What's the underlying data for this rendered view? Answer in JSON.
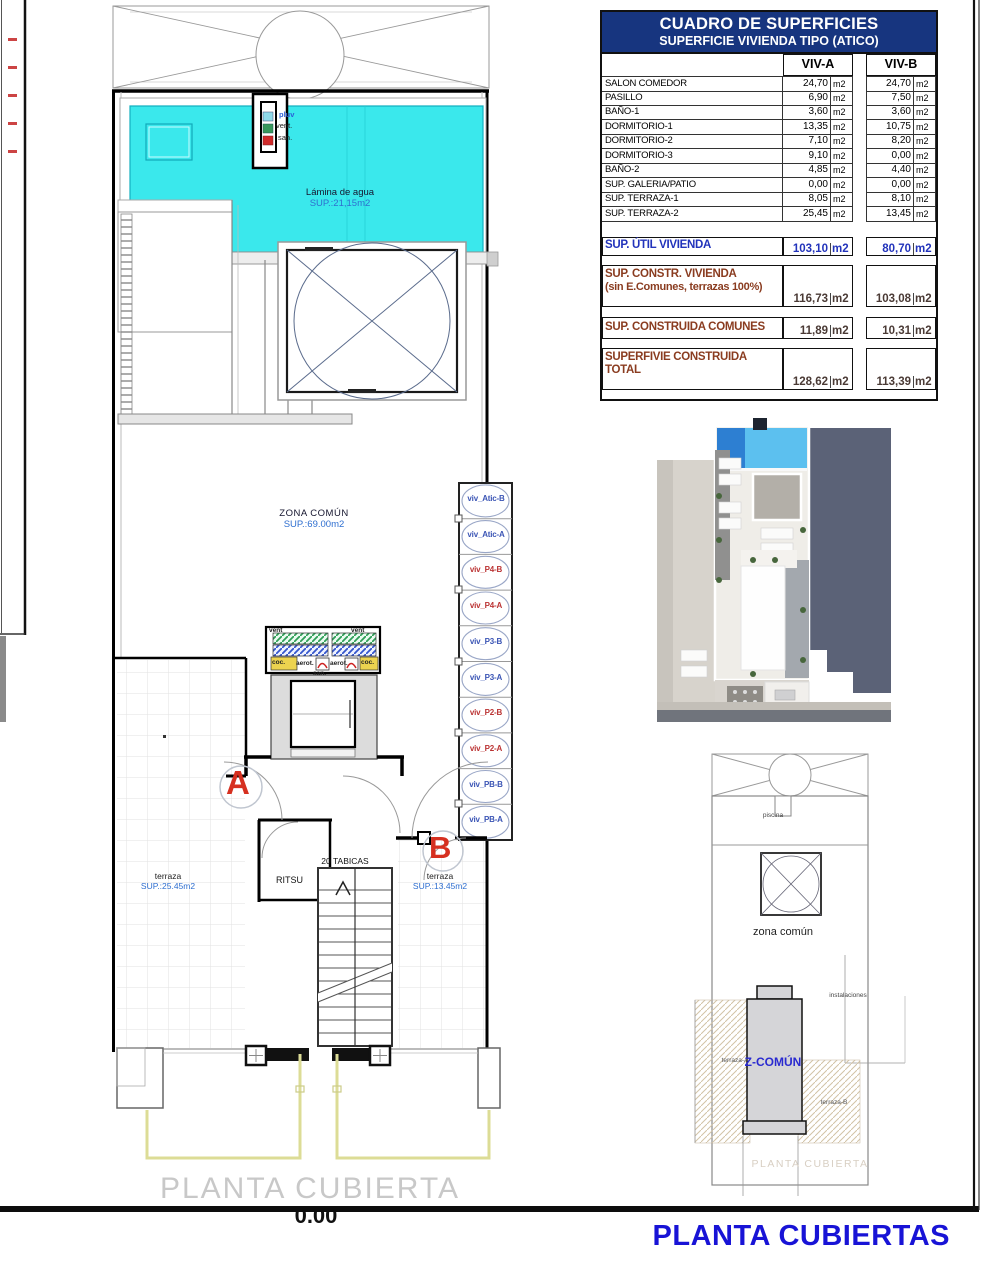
{
  "table": {
    "title": "CUADRO DE SUPERFICIES",
    "subtitle": "SUPERFICIE VIVIENDA TIPO (ATICO)",
    "col_a": "VIV-A",
    "col_b": "VIV-B",
    "unit": "m2",
    "rows": [
      {
        "label": "SALON COMEDOR",
        "a": "24,70",
        "b": "24,70"
      },
      {
        "label": "PASILLO",
        "a": "6,90",
        "b": "7,50"
      },
      {
        "label": "BAÑO-1",
        "a": "3,60",
        "b": "3,60"
      },
      {
        "label": "DORMITORIO-1",
        "a": "13,35",
        "b": "10,75"
      },
      {
        "label": "DORMITORIO-2",
        "a": "7,10",
        "b": "8,20"
      },
      {
        "label": "DORMITORIO-3",
        "a": "9,10",
        "b": "0,00"
      },
      {
        "label": "BAÑO-2",
        "a": "4,85",
        "b": "4,40"
      },
      {
        "label": "SUP. GALERIA/PATIO",
        "a": "0,00",
        "b": "0,00"
      },
      {
        "label": "SUP. TERRAZA-1",
        "a": "8,05",
        "b": "8,10"
      },
      {
        "label": "SUP. TERRAZA-2",
        "a": "25,45",
        "b": "13,45"
      }
    ],
    "summary": {
      "util": {
        "label": "SUP. ÚTIL VIVIENDA",
        "a": "103,10",
        "b": "80,70"
      },
      "constr": {
        "label1": "SUP. CONSTR. VIVIENDA",
        "label2": "(sin E.Comunes, terrazas 100%)",
        "a": "116,73",
        "b": "103,08"
      },
      "comunes": {
        "label": "SUP. CONSTRUIDA COMUNES",
        "a": "11,89",
        "b": "10,31"
      },
      "total": {
        "label1": "SUPERFIVIE CONSTRUIDA",
        "label2": "TOTAL",
        "a": "128,62",
        "b": "113,39"
      }
    }
  },
  "plan": {
    "shaft": {
      "pluv": "pluv",
      "vent": "vent.",
      "san": "san."
    },
    "pool": {
      "label": "Lámina de agua",
      "area": "SUP.:21,15m2"
    },
    "zona_comun": {
      "label": "ZONA COMÚN",
      "area": "SUP.:69.00m2"
    },
    "machine": {
      "vent_l": "vent",
      "vent_r": "vent",
      "coc_l": "coc.",
      "aero_l": "aerot.",
      "aero_r": "aerot.",
      "coc_r": "coc.",
      "san": "san."
    },
    "risers": [
      {
        "label": "viv_Atic-B",
        "color": "#3b55b5"
      },
      {
        "label": "viv_Atic-A",
        "color": "#3b55b5"
      },
      {
        "label": "viv_P4-B",
        "color": "#bb3333"
      },
      {
        "label": "viv_P4-A",
        "color": "#bb3333"
      },
      {
        "label": "viv_P3-B",
        "color": "#3b55b5"
      },
      {
        "label": "viv_P3-A",
        "color": "#3b55b5"
      },
      {
        "label": "viv_P2-B",
        "color": "#bb3333"
      },
      {
        "label": "viv_P2-A",
        "color": "#bb3333"
      },
      {
        "label": "viv_PB-B",
        "color": "#3b55b5"
      },
      {
        "label": "viv_PB-A",
        "color": "#3b55b5"
      }
    ],
    "marker_a": "A",
    "marker_b": "B",
    "tabicas": "20 TABICAS",
    "ritsu": "RITSU",
    "terraza_left": {
      "label": "terraza",
      "area": "SUP.:25.45m2"
    },
    "terraza_right": {
      "label": "terraza",
      "area": "SUP.:13.45m2"
    },
    "title": "PLANTA CUBIERTA",
    "elevation": "0.00"
  },
  "mini_plan": {
    "piscina": "piscina",
    "zona_comun": "zona común",
    "instalaciones": "instalaciones",
    "terraza_a": "terraza-A",
    "z_comun": "Z-COMÚN",
    "terraza_b": "terraza-B",
    "caption": "PLANTA CUBIERTA"
  },
  "footer": {
    "title": "PLANTA CUBIERTAS"
  },
  "colors": {
    "header_navy": "#17357f",
    "accent_blue": "#2233bb",
    "maroon": "#8a3c20",
    "pool_cyan": "#3ae8ec",
    "title_blue": "#1813d6",
    "marker_red": "#d63020"
  }
}
